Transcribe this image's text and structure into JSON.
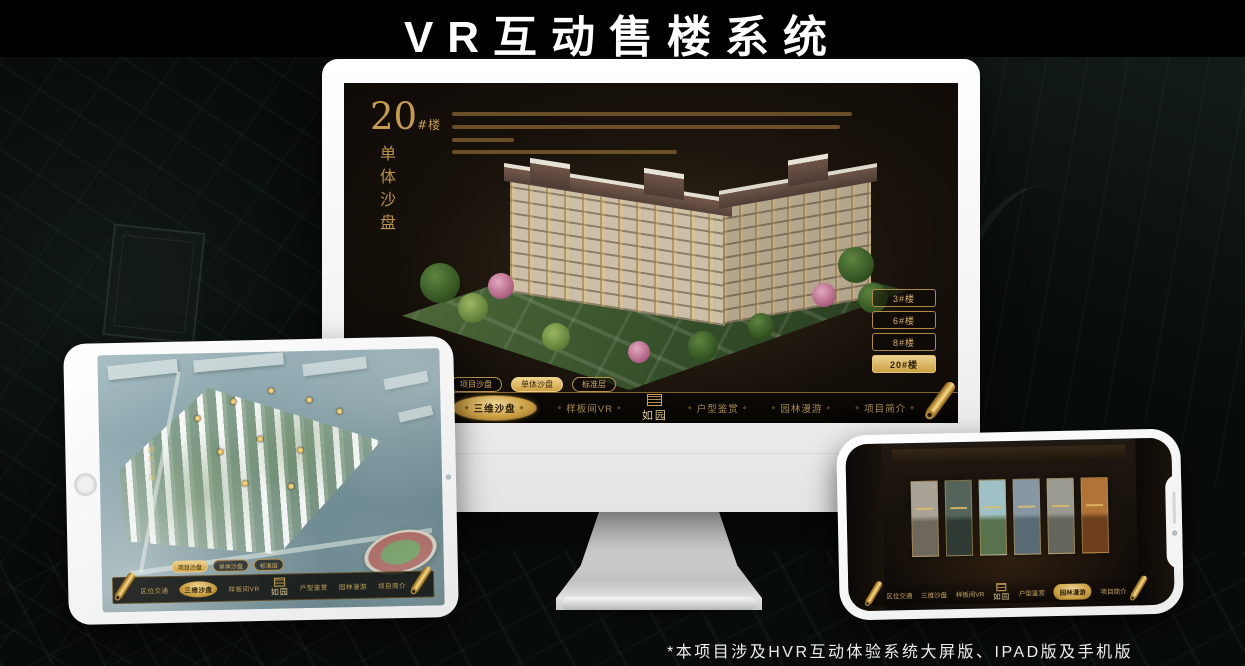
{
  "page": {
    "title": "VR互动售楼系统",
    "footnote": "*本项目涉及HVR互动体验系统大屏版、IPAD版及手机版"
  },
  "colors": {
    "accent_gold": "#c59b4f",
    "accent_gold_bright": "#ecd089",
    "screen_background": "#16100a",
    "device_body_white": "#f5f5f5",
    "page_background": "#070b09"
  },
  "monitor": {
    "screen_title": {
      "number": "20",
      "unit": "#楼",
      "subtitle": "单体沙盘"
    },
    "floor_buttons": [
      {
        "label": "3#楼",
        "selected": false
      },
      {
        "label": "6#楼",
        "selected": false
      },
      {
        "label": "8#楼",
        "selected": false
      },
      {
        "label": "20#楼",
        "selected": true
      }
    ],
    "sub_tabs": [
      {
        "label": "项目沙盘",
        "selected": false
      },
      {
        "label": "单体沙盘",
        "selected": true
      },
      {
        "label": "标准层",
        "selected": false
      }
    ],
    "menu": {
      "logo": "如园",
      "items": [
        {
          "label": "区位交通",
          "selected": false
        },
        {
          "label": "三维沙盘",
          "selected": true
        },
        {
          "label": "样板间VR",
          "selected": false
        },
        {
          "label": "户型鉴赏",
          "selected": false
        },
        {
          "label": "园林漫游",
          "selected": false
        },
        {
          "label": "项目简介",
          "selected": false
        }
      ]
    }
  },
  "tablet": {
    "road_label": "园区三路",
    "sub_tabs": [
      {
        "label": "项目沙盘",
        "selected": true
      },
      {
        "label": "单体沙盘",
        "selected": false
      },
      {
        "label": "标准层",
        "selected": false
      }
    ],
    "menu": {
      "logo": "如园",
      "items": [
        {
          "label": "区位交通",
          "selected": false
        },
        {
          "label": "三维沙盘",
          "selected": true
        },
        {
          "label": "样板间VR",
          "selected": false
        },
        {
          "label": "户型鉴赏",
          "selected": false
        },
        {
          "label": "园林漫游",
          "selected": false
        },
        {
          "label": "项目简介",
          "selected": false
        }
      ]
    }
  },
  "phone": {
    "menu": {
      "logo": "如园",
      "items": [
        {
          "label": "区位交通",
          "selected": false
        },
        {
          "label": "三维沙盘",
          "selected": false
        },
        {
          "label": "样板间VR",
          "selected": false
        },
        {
          "label": "户型鉴赏",
          "selected": false
        },
        {
          "label": "园林漫游",
          "selected": true
        },
        {
          "label": "项目简介",
          "selected": false
        }
      ]
    },
    "gallery_panels": [
      {
        "top": "#a8a396",
        "bottom": "#6e675c"
      },
      {
        "top": "#55645a",
        "bottom": "#2e3a33"
      },
      {
        "top": "#9fc0c4",
        "bottom": "#58724e"
      },
      {
        "top": "#8798a4",
        "bottom": "#5a6a74"
      },
      {
        "top": "#9a9a90",
        "bottom": "#62665c"
      },
      {
        "top": "#b07438",
        "bottom": "#6e3f1c"
      }
    ]
  }
}
